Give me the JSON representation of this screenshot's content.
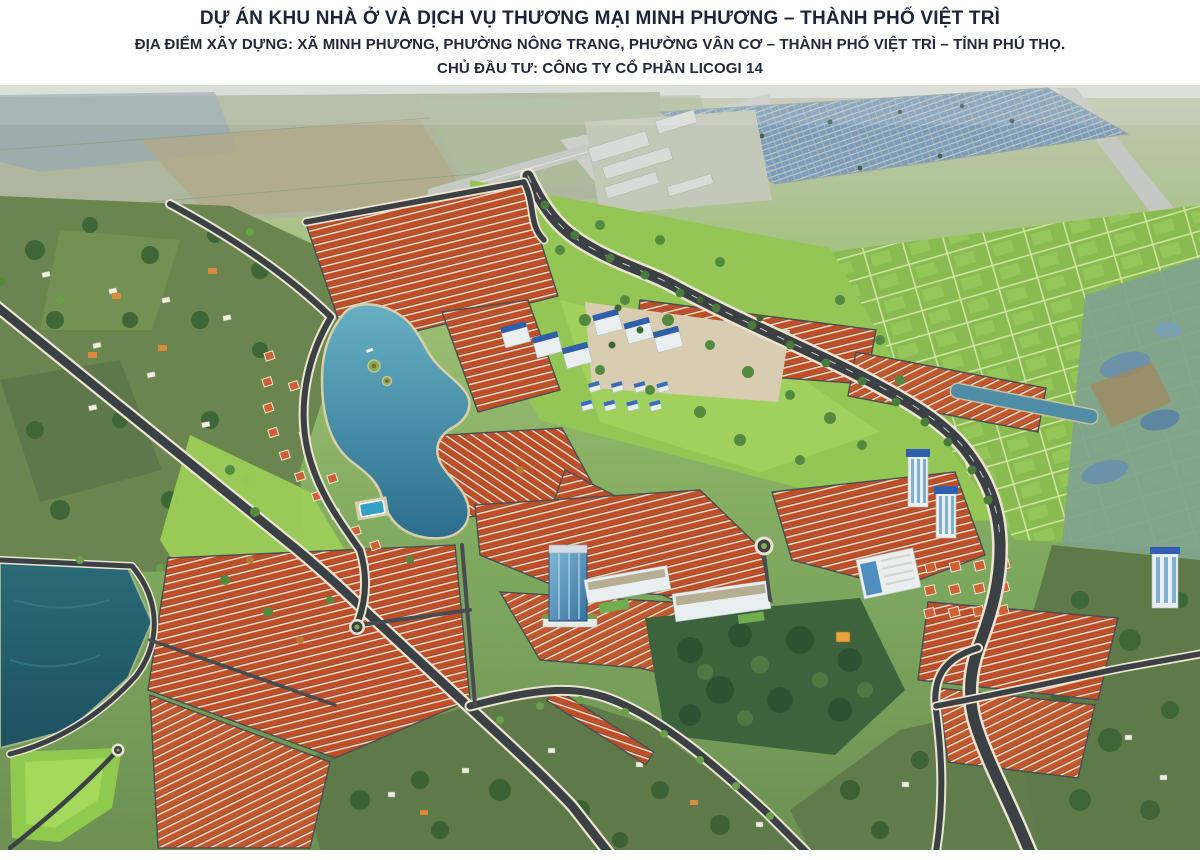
{
  "header": {
    "title": "DỰ ÁN KHU NHÀ Ở VÀ DỊCH VỤ THƯƠNG MẠI MINH PHƯƠNG – THÀNH PHỐ VIỆT TRÌ",
    "location_line": "ĐỊA ĐIỂM XÂY DỰNG: XÃ MINH PHƯƠNG, PHƯỜNG NÔNG TRANG, PHƯỜNG VÂN CƠ – THÀNH PHỐ VIỆT TRÌ – TỈNH PHÚ THỌ.",
    "investor_line": "CHỦ ĐẦU TƯ: CÔNG TY CỔ PHẦN LICOGI 14"
  },
  "colors": {
    "title_text": "#1d2438",
    "subtitle_text": "#23283a",
    "page_background": "#ffffff",
    "roof_red": "#bf4e28",
    "water_blue": "#2d6e8e",
    "lake_dark_teal": "#215f6d",
    "park_green": "#93c654",
    "road_asphalt": "#3b4044",
    "sidewalk_cream": "#ece4d0",
    "apartment_roof_blue": "#2e5fa8"
  }
}
